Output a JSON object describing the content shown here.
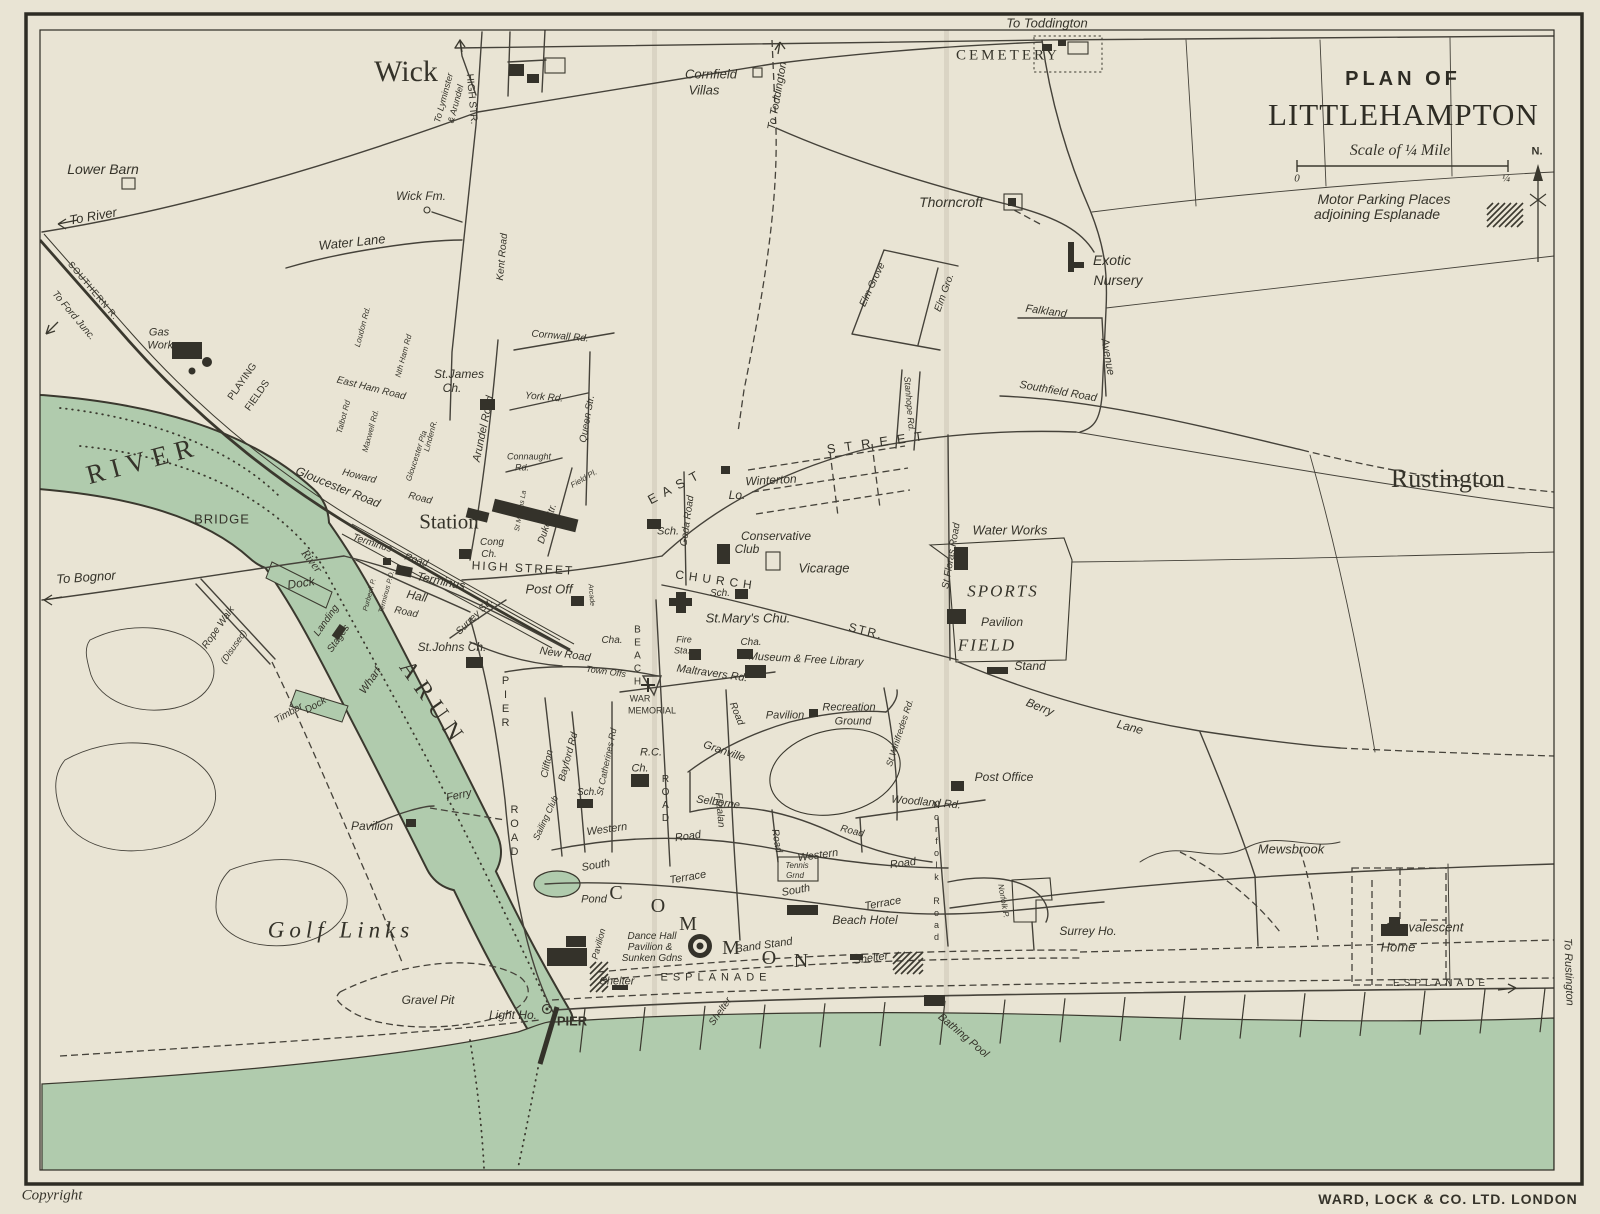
{
  "title": {
    "line1": "PLAN OF",
    "line2": "LITTLEHAMPTON"
  },
  "scale": {
    "label": "Scale of ¼ Mile",
    "zero": "0",
    "quarter": "¼"
  },
  "legend": {
    "parking_line1": "Motor Parking Places",
    "parking_line2": "adjoining  Esplanade"
  },
  "compass": {
    "north": "N."
  },
  "footer": {
    "copyright": "Copyright",
    "publisher": "WARD, LOCK & CO. LTD. LONDON"
  },
  "colors": {
    "paper": "#e9e4d4",
    "ink": "#3a382e",
    "water_green": "#b0cbad"
  },
  "labels": [
    {
      "t": "Wick",
      "x": 406,
      "y": 72,
      "s": 30,
      "c": "se"
    },
    {
      "t": "Rustington",
      "x": 1448,
      "y": 479,
      "s": 26,
      "c": "se"
    },
    {
      "t": "CEMETERY",
      "x": 1008,
      "y": 56,
      "s": 15,
      "c": "se",
      "ls": 3
    },
    {
      "t": "To Toddington",
      "x": 1047,
      "y": 23,
      "s": 13
    },
    {
      "t": "To Toddington",
      "x": 778,
      "y": 96,
      "s": 11,
      "r": -80
    },
    {
      "t": "Cornfield",
      "x": 711,
      "y": 74,
      "s": 13
    },
    {
      "t": "Villas",
      "x": 704,
      "y": 90,
      "s": 13
    },
    {
      "t": "Thorncroft",
      "x": 951,
      "y": 202,
      "s": 14
    },
    {
      "t": "Exotic",
      "x": 1112,
      "y": 260,
      "s": 14
    },
    {
      "t": "Nursery",
      "x": 1118,
      "y": 280,
      "s": 14
    },
    {
      "t": "Falkland",
      "x": 1046,
      "y": 312,
      "s": 11,
      "r": 8
    },
    {
      "t": "Avenue",
      "x": 1107,
      "y": 357,
      "s": 11,
      "r": 80
    },
    {
      "t": "Southfield Road",
      "x": 1058,
      "y": 392,
      "s": 11,
      "r": 10
    },
    {
      "t": "Elm Grove",
      "x": 873,
      "y": 285,
      "s": 10,
      "r": -65
    },
    {
      "t": "Elm Gro.",
      "x": 945,
      "y": 293,
      "s": 10,
      "r": -70
    },
    {
      "t": "Stanhope Rd.",
      "x": 909,
      "y": 404,
      "s": 9,
      "r": 85
    },
    {
      "t": "Lower Barn",
      "x": 103,
      "y": 169,
      "s": 14
    },
    {
      "t": "To River",
      "x": 93,
      "y": 216,
      "s": 13,
      "r": -10
    },
    {
      "t": "Water Lane",
      "x": 352,
      "y": 242,
      "s": 13,
      "r": -6
    },
    {
      "t": "Wick Fm.",
      "x": 421,
      "y": 196,
      "s": 12
    },
    {
      "t": "To Lyminster",
      "x": 444,
      "y": 98,
      "s": 9,
      "r": -75
    },
    {
      "t": "& Arundel",
      "x": 456,
      "y": 104,
      "s": 9,
      "r": -75
    },
    {
      "t": "HIGH STR.",
      "x": 471,
      "y": 99,
      "s": 10,
      "r": 85,
      "c": "hs"
    },
    {
      "t": "Kent Road",
      "x": 503,
      "y": 257,
      "s": 10,
      "r": -85
    },
    {
      "t": "SOUTHERN R.",
      "x": 93,
      "y": 291,
      "s": 9,
      "r": 50,
      "c": "hs",
      "ls": 1
    },
    {
      "t": "To Ford Junc.",
      "x": 73,
      "y": 316,
      "s": 10,
      "r": 50
    },
    {
      "t": "Gas",
      "x": 159,
      "y": 333,
      "s": 11
    },
    {
      "t": "Works",
      "x": 163,
      "y": 346,
      "s": 11
    },
    {
      "t": "PLAYING",
      "x": 243,
      "y": 382,
      "s": 10,
      "r": -55,
      "c": "hs"
    },
    {
      "t": "FIELDS",
      "x": 258,
      "y": 396,
      "s": 10,
      "r": -55,
      "c": "hs"
    },
    {
      "t": "East Ham Road",
      "x": 371,
      "y": 389,
      "s": 10,
      "r": 14
    },
    {
      "t": "Loudon Rd.",
      "x": 363,
      "y": 327,
      "s": 8,
      "r": -75
    },
    {
      "t": "Talbot Rd",
      "x": 344,
      "y": 417,
      "s": 8,
      "r": -75
    },
    {
      "t": "Maxwell Rd.",
      "x": 371,
      "y": 431,
      "s": 8,
      "r": -75
    },
    {
      "t": "Nth Ham Rd",
      "x": 404,
      "y": 356,
      "s": 8,
      "r": -75
    },
    {
      "t": "Gloucester Pla",
      "x": 417,
      "y": 456,
      "s": 8,
      "r": -72
    },
    {
      "t": "LindenR.",
      "x": 431,
      "y": 436,
      "s": 8,
      "r": -75
    },
    {
      "t": "Howard",
      "x": 359,
      "y": 477,
      "s": 10,
      "r": 14
    },
    {
      "t": "Road",
      "x": 420,
      "y": 499,
      "s": 10,
      "r": 14
    },
    {
      "t": "Gloucester Road",
      "x": 338,
      "y": 487,
      "s": 12,
      "r": 22
    },
    {
      "t": "RIVER",
      "x": 143,
      "y": 461,
      "s": 27,
      "r": -15,
      "c": "se",
      "ls": 7
    },
    {
      "t": "BRIDGE",
      "x": 222,
      "y": 519,
      "s": 13,
      "c": "hs",
      "ls": 1
    },
    {
      "t": "River",
      "x": 312,
      "y": 561,
      "s": 12,
      "r": 52,
      "c": "si"
    },
    {
      "t": "Station",
      "x": 449,
      "y": 522,
      "s": 21,
      "c": "se"
    },
    {
      "t": "St.James",
      "x": 459,
      "y": 374,
      "s": 12
    },
    {
      "t": "Ch.",
      "x": 452,
      "y": 388,
      "s": 12
    },
    {
      "t": "York Rd.",
      "x": 544,
      "y": 398,
      "s": 10,
      "r": 5
    },
    {
      "t": "Cornwall Rd.",
      "x": 560,
      "y": 337,
      "s": 10,
      "r": 5
    },
    {
      "t": "Connaught",
      "x": 529,
      "y": 457,
      "s": 9
    },
    {
      "t": "Rd.",
      "x": 522,
      "y": 468,
      "s": 9
    },
    {
      "t": "Arundel Road",
      "x": 484,
      "y": 429,
      "s": 11,
      "r": -78
    },
    {
      "t": "Queen Str.",
      "x": 588,
      "y": 419,
      "s": 10,
      "r": -80
    },
    {
      "t": "Duke Str.",
      "x": 548,
      "y": 524,
      "s": 10,
      "r": -72
    },
    {
      "t": "Field Pl.",
      "x": 584,
      "y": 479,
      "s": 8,
      "r": -30
    },
    {
      "t": "St Martins La",
      "x": 521,
      "y": 511,
      "s": 7,
      "r": -80
    },
    {
      "t": "Cong",
      "x": 492,
      "y": 543,
      "s": 10
    },
    {
      "t": "Ch.",
      "x": 489,
      "y": 555,
      "s": 10
    },
    {
      "t": "HIGH STREET",
      "x": 523,
      "y": 568,
      "s": 12,
      "r": 3,
      "c": "hs",
      "ls": 2
    },
    {
      "t": "Terminus",
      "x": 372,
      "y": 544,
      "s": 10,
      "r": 18
    },
    {
      "t": "Road",
      "x": 416,
      "y": 561,
      "s": 10,
      "r": 18
    },
    {
      "t": "Terminus",
      "x": 441,
      "y": 581,
      "s": 12,
      "r": 12
    },
    {
      "t": "Hall",
      "x": 417,
      "y": 596,
      "s": 12,
      "r": 12
    },
    {
      "t": "Road",
      "x": 406,
      "y": 613,
      "s": 10,
      "r": 12
    },
    {
      "t": "Terminus P.O.",
      "x": 387,
      "y": 592,
      "s": 7,
      "r": -75
    },
    {
      "t": "Purbeck P.",
      "x": 370,
      "y": 595,
      "s": 7,
      "r": -75
    },
    {
      "t": "Surrey Str.",
      "x": 475,
      "y": 617,
      "s": 10,
      "r": -45
    },
    {
      "t": "St.Johns Ch.",
      "x": 452,
      "y": 647,
      "s": 12
    },
    {
      "t": "Post Off",
      "x": 549,
      "y": 589,
      "s": 13
    },
    {
      "t": "Arcade",
      "x": 591,
      "y": 595,
      "s": 7,
      "r": 85
    },
    {
      "t": "New Road",
      "x": 565,
      "y": 655,
      "s": 11,
      "r": 8
    },
    {
      "t": "Town Offs",
      "x": 606,
      "y": 672,
      "s": 9,
      "r": 8
    },
    {
      "t": "Cha.",
      "x": 612,
      "y": 641,
      "s": 10
    },
    {
      "t": "EAST",
      "x": 676,
      "y": 486,
      "s": 13,
      "r": -28,
      "c": "hs",
      "ls": 7
    },
    {
      "t": "STREET",
      "x": 879,
      "y": 442,
      "s": 13,
      "r": -8,
      "c": "hs",
      "ls": 9
    },
    {
      "t": "Winterton",
      "x": 771,
      "y": 480,
      "s": 12,
      "r": -3
    },
    {
      "t": "Lo.",
      "x": 737,
      "y": 495,
      "s": 12
    },
    {
      "t": "Sch.",
      "x": 668,
      "y": 532,
      "s": 11
    },
    {
      "t": "Conservative",
      "x": 776,
      "y": 536,
      "s": 12
    },
    {
      "t": "Club",
      "x": 747,
      "y": 549,
      "s": 12
    },
    {
      "t": "Vicarage",
      "x": 824,
      "y": 568,
      "s": 13
    },
    {
      "t": "Goda Road",
      "x": 688,
      "y": 521,
      "s": 10,
      "r": -82
    },
    {
      "t": "CHURCH",
      "x": 716,
      "y": 580,
      "s": 12,
      "r": 8,
      "c": "hs",
      "ls": 5
    },
    {
      "t": "STR.",
      "x": 866,
      "y": 631,
      "s": 12,
      "r": 14,
      "c": "hs",
      "ls": 2
    },
    {
      "t": "Sch.",
      "x": 720,
      "y": 594,
      "s": 10
    },
    {
      "t": "St.Mary's Chu.",
      "x": 748,
      "y": 618,
      "s": 13
    },
    {
      "t": "Fire",
      "x": 684,
      "y": 640,
      "s": 9
    },
    {
      "t": "Sta.",
      "x": 682,
      "y": 651,
      "s": 9
    },
    {
      "t": "Cha.",
      "x": 751,
      "y": 643,
      "s": 10
    },
    {
      "t": "Museum & Free Library",
      "x": 806,
      "y": 660,
      "s": 11,
      "r": 3
    },
    {
      "t": "Maltravers Rd.",
      "x": 712,
      "y": 674,
      "s": 11,
      "r": 8
    },
    {
      "t": "WAR",
      "x": 640,
      "y": 699,
      "s": 9,
      "c": "hs"
    },
    {
      "t": "MEMORIAL",
      "x": 652,
      "y": 711,
      "s": 9,
      "c": "hs"
    },
    {
      "t": "St Floras Road",
      "x": 952,
      "y": 556,
      "s": 10,
      "r": -80
    },
    {
      "t": "Water Works",
      "x": 1010,
      "y": 530,
      "s": 13
    },
    {
      "t": "SPORTS",
      "x": 1003,
      "y": 591,
      "s": 17,
      "c": "si",
      "ls": 2
    },
    {
      "t": "FIELD",
      "x": 987,
      "y": 645,
      "s": 17,
      "c": "si",
      "ls": 2
    },
    {
      "t": "Pavilion",
      "x": 1002,
      "y": 622,
      "s": 12
    },
    {
      "t": "Stand",
      "x": 1030,
      "y": 666,
      "s": 12
    },
    {
      "t": "Berry",
      "x": 1040,
      "y": 707,
      "s": 12,
      "r": 22
    },
    {
      "t": "Lane",
      "x": 1130,
      "y": 727,
      "s": 12,
      "r": 15
    },
    {
      "t": "Pavilion",
      "x": 785,
      "y": 716,
      "s": 11
    },
    {
      "t": "Recreation",
      "x": 849,
      "y": 708,
      "s": 11
    },
    {
      "t": "Ground",
      "x": 853,
      "y": 722,
      "s": 11
    },
    {
      "t": "St Winifredes Rd.",
      "x": 900,
      "y": 733,
      "s": 9,
      "r": -72
    },
    {
      "t": "Granville",
      "x": 724,
      "y": 752,
      "s": 11,
      "r": 19
    },
    {
      "t": "Road",
      "x": 736,
      "y": 714,
      "s": 10,
      "r": 68
    },
    {
      "t": "R.C.",
      "x": 651,
      "y": 753,
      "s": 11
    },
    {
      "t": "Ch.",
      "x": 640,
      "y": 769,
      "s": 11
    },
    {
      "t": "Sch.",
      "x": 587,
      "y": 793,
      "s": 10
    },
    {
      "t": "Clifton",
      "x": 548,
      "y": 764,
      "s": 10,
      "r": -78
    },
    {
      "t": "Bayford Rd",
      "x": 569,
      "y": 757,
      "s": 10,
      "r": -75
    },
    {
      "t": "St Catherines Rd",
      "x": 607,
      "y": 762,
      "s": 9,
      "r": -78
    },
    {
      "t": "Sailing Club",
      "x": 546,
      "y": 818,
      "s": 9,
      "r": -65
    },
    {
      "t": "BEACH",
      "x": 637,
      "y": 657,
      "s": 10,
      "c": "vs"
    },
    {
      "t": "ROAD",
      "x": 665,
      "y": 800,
      "s": 10,
      "c": "vs"
    },
    {
      "t": "PIER",
      "x": 505,
      "y": 703,
      "s": 11,
      "c": "vs"
    },
    {
      "t": "ROAD",
      "x": 514,
      "y": 832,
      "s": 11,
      "c": "vs"
    },
    {
      "t": "Selborne",
      "x": 718,
      "y": 803,
      "s": 11,
      "r": 8
    },
    {
      "t": "Road",
      "x": 852,
      "y": 832,
      "s": 10,
      "r": 14
    },
    {
      "t": "Road",
      "x": 776,
      "y": 841,
      "s": 10,
      "r": 80
    },
    {
      "t": "Fitzalan",
      "x": 719,
      "y": 810,
      "s": 10,
      "r": 85
    },
    {
      "t": "Western",
      "x": 607,
      "y": 830,
      "s": 11,
      "r": -8
    },
    {
      "t": "Road",
      "x": 688,
      "y": 837,
      "s": 11,
      "r": -8
    },
    {
      "t": "Western",
      "x": 818,
      "y": 856,
      "s": 11,
      "r": -8
    },
    {
      "t": "Road",
      "x": 903,
      "y": 864,
      "s": 11,
      "r": -8
    },
    {
      "t": "South",
      "x": 596,
      "y": 866,
      "s": 11,
      "r": -10
    },
    {
      "t": "Terrace",
      "x": 688,
      "y": 878,
      "s": 11,
      "r": -10
    },
    {
      "t": "South",
      "x": 796,
      "y": 891,
      "s": 11,
      "r": -10
    },
    {
      "t": "Terrace",
      "x": 883,
      "y": 904,
      "s": 11,
      "r": -10
    },
    {
      "t": "Tennis",
      "x": 797,
      "y": 866,
      "s": 8
    },
    {
      "t": "Grnd",
      "x": 795,
      "y": 876,
      "s": 8
    },
    {
      "t": "Beach Hotel",
      "x": 865,
      "y": 920,
      "s": 12
    },
    {
      "t": "Woodland Rd.",
      "x": 926,
      "y": 803,
      "s": 11,
      "r": 5
    },
    {
      "t": "Post Office",
      "x": 1004,
      "y": 777,
      "s": 12
    },
    {
      "t": "Norfolk Road",
      "x": 936,
      "y": 872,
      "s": 9,
      "c": "vs"
    },
    {
      "t": "Norfolk P.",
      "x": 1003,
      "y": 901,
      "s": 8,
      "r": 80
    },
    {
      "t": "Surrey Ho.",
      "x": 1088,
      "y": 931,
      "s": 12
    },
    {
      "t": "Mewsbrook",
      "x": 1291,
      "y": 849,
      "s": 13
    },
    {
      "t": "Convalescent",
      "x": 1424,
      "y": 927,
      "s": 13
    },
    {
      "t": "Home",
      "x": 1398,
      "y": 947,
      "s": 13
    },
    {
      "t": "Golf Links",
      "x": 341,
      "y": 930,
      "s": 23,
      "c": "si",
      "ls": 5
    },
    {
      "t": "Gravel Pit",
      "x": 428,
      "y": 1000,
      "s": 12
    },
    {
      "t": "Light Ho.",
      "x": 513,
      "y": 1015,
      "s": 12
    },
    {
      "t": "PIER",
      "x": 572,
      "y": 1021,
      "s": 13,
      "c": "b"
    },
    {
      "t": "Ferry",
      "x": 459,
      "y": 796,
      "s": 11,
      "r": -12
    },
    {
      "t": "Pavilion",
      "x": 372,
      "y": 826,
      "s": 12
    },
    {
      "t": "Wharf",
      "x": 371,
      "y": 681,
      "s": 11,
      "r": -55
    },
    {
      "t": "ARUN",
      "x": 433,
      "y": 704,
      "s": 24,
      "r": 55,
      "c": "se",
      "ls": 8
    },
    {
      "t": "Timber",
      "x": 289,
      "y": 714,
      "s": 10,
      "r": -30
    },
    {
      "t": "Dock",
      "x": 316,
      "y": 706,
      "s": 10,
      "r": -30
    },
    {
      "t": "Dock",
      "x": 301,
      "y": 583,
      "s": 12,
      "r": -8
    },
    {
      "t": "Landing",
      "x": 327,
      "y": 621,
      "s": 10,
      "r": -55
    },
    {
      "t": "Stages",
      "x": 339,
      "y": 639,
      "s": 10,
      "r": -55
    },
    {
      "t": "Rope Walk",
      "x": 219,
      "y": 628,
      "s": 10,
      "r": -55
    },
    {
      "t": "(Disused)",
      "x": 234,
      "y": 647,
      "s": 9,
      "r": -55
    },
    {
      "t": "To Bognor",
      "x": 86,
      "y": 577,
      "s": 13,
      "r": -4
    },
    {
      "t": "Pond",
      "x": 594,
      "y": 900,
      "s": 11
    },
    {
      "t": "Pavilion",
      "x": 599,
      "y": 944,
      "s": 9,
      "r": -75
    },
    {
      "t": "Dance Hall",
      "x": 652,
      "y": 937,
      "s": 10
    },
    {
      "t": "Pavilion &",
      "x": 650,
      "y": 948,
      "s": 10
    },
    {
      "t": "Sunken Gdns",
      "x": 652,
      "y": 959,
      "s": 10
    },
    {
      "t": "Band Stand",
      "x": 764,
      "y": 946,
      "s": 11,
      "r": -8
    },
    {
      "t": "Shelter",
      "x": 617,
      "y": 982,
      "s": 11
    },
    {
      "t": "ESPLANADE",
      "x": 716,
      "y": 978,
      "s": 11,
      "c": "hs",
      "ls": 5
    },
    {
      "t": "Shelter",
      "x": 871,
      "y": 959,
      "s": 11,
      "r": -8
    },
    {
      "t": "Shelter",
      "x": 721,
      "y": 1012,
      "s": 10,
      "r": -55
    },
    {
      "t": "Bathing Pool",
      "x": 963,
      "y": 1036,
      "s": 11,
      "r": 40
    },
    {
      "t": "C",
      "x": 616,
      "y": 893,
      "s": 20,
      "c": "se"
    },
    {
      "t": "O",
      "x": 658,
      "y": 906,
      "s": 20,
      "c": "se"
    },
    {
      "t": "M",
      "x": 688,
      "y": 924,
      "s": 20,
      "c": "se"
    },
    {
      "t": "M",
      "x": 731,
      "y": 948,
      "s": 20,
      "c": "se"
    },
    {
      "t": "O",
      "x": 769,
      "y": 958,
      "s": 20,
      "c": "se"
    },
    {
      "t": "N",
      "x": 801,
      "y": 961,
      "s": 20,
      "c": "se"
    },
    {
      "t": "ESPLANADE",
      "x": 1441,
      "y": 984,
      "s": 10,
      "c": "hs",
      "ls": 4
    },
    {
      "t": "To Rustington",
      "x": 1568,
      "y": 972,
      "s": 11,
      "r": 88
    }
  ]
}
